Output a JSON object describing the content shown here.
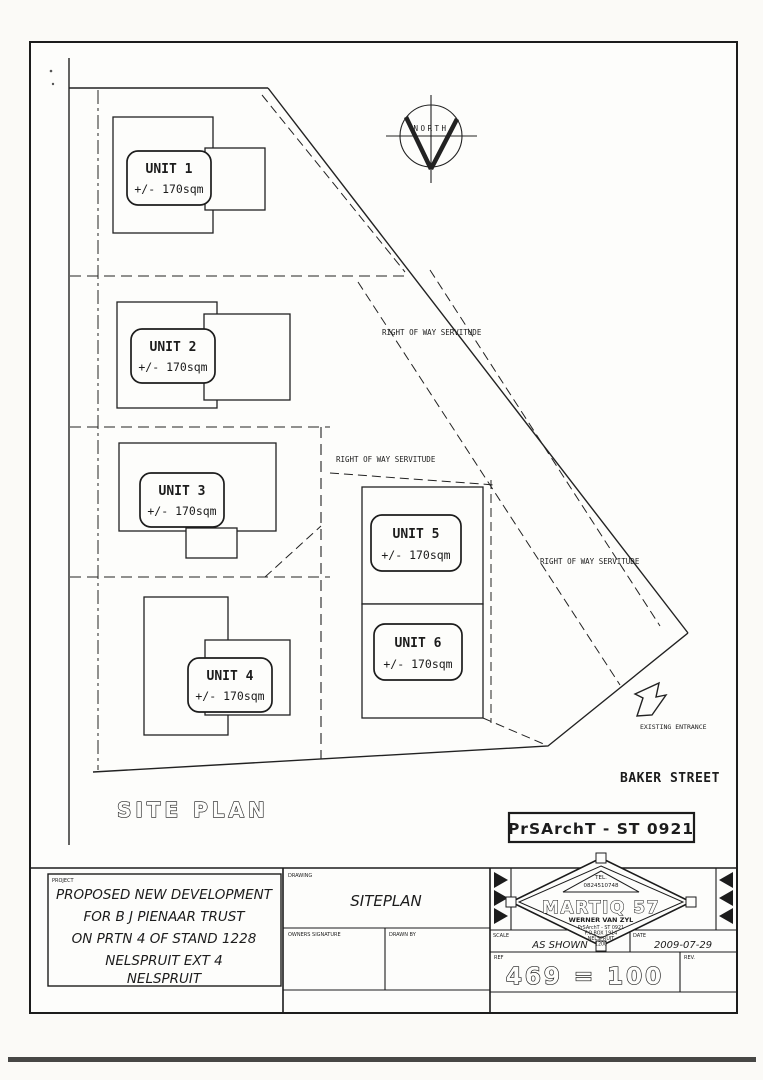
{
  "drawing": {
    "title": "SITE PLAN",
    "stamp": "PrSArchT - ST 0921",
    "north_label": "NORTH",
    "servitude_label": "RIGHT OF WAY SERVITUDE",
    "entrance_label": "EXISTING ENTRANCE",
    "street_label": "BAKER STREET"
  },
  "units": [
    {
      "name": "UNIT 1",
      "area": "+/- 170sqm"
    },
    {
      "name": "UNIT 2",
      "area": "+/- 170sqm"
    },
    {
      "name": "UNIT 3",
      "area": "+/- 170sqm"
    },
    {
      "name": "UNIT 4",
      "area": "+/- 170sqm"
    },
    {
      "name": "UNIT 5",
      "area": "+/- 170sqm"
    },
    {
      "name": "UNIT 6",
      "area": "+/- 170sqm"
    }
  ],
  "title_block": {
    "project_label": "PROJECT",
    "project_lines": [
      "PROPOSED NEW DEVELOPMENT",
      "FOR B J PIENAAR TRUST",
      "ON PRTN 4 OF STAND 1228",
      "NELSPRUIT EXT 4",
      "NELSPRUIT"
    ],
    "drawing_label": "DRAWING",
    "drawing_name": "SITEPLAN",
    "owners_signature_label": "OWNERS SIGNATURE",
    "drawn_by_label": "DRAWN BY",
    "scale_label": "SCALE",
    "scale_value": "AS SHOWN",
    "date_label": "DATE",
    "date_value": "2009-07-29",
    "number_label": "REF",
    "number_value": "469 = 100",
    "rev_label": "REV."
  },
  "logo": {
    "tel_label": "TEL.",
    "tel_value": "0824510748",
    "company": "MARTIQ 57",
    "person": "WERNER VAN ZYL",
    "registration": "PrSArchT - ST 0921",
    "address_line1": "P.O.BOX 1914",
    "address_line2": "NELSPRUIT",
    "address_line3": "1200"
  }
}
